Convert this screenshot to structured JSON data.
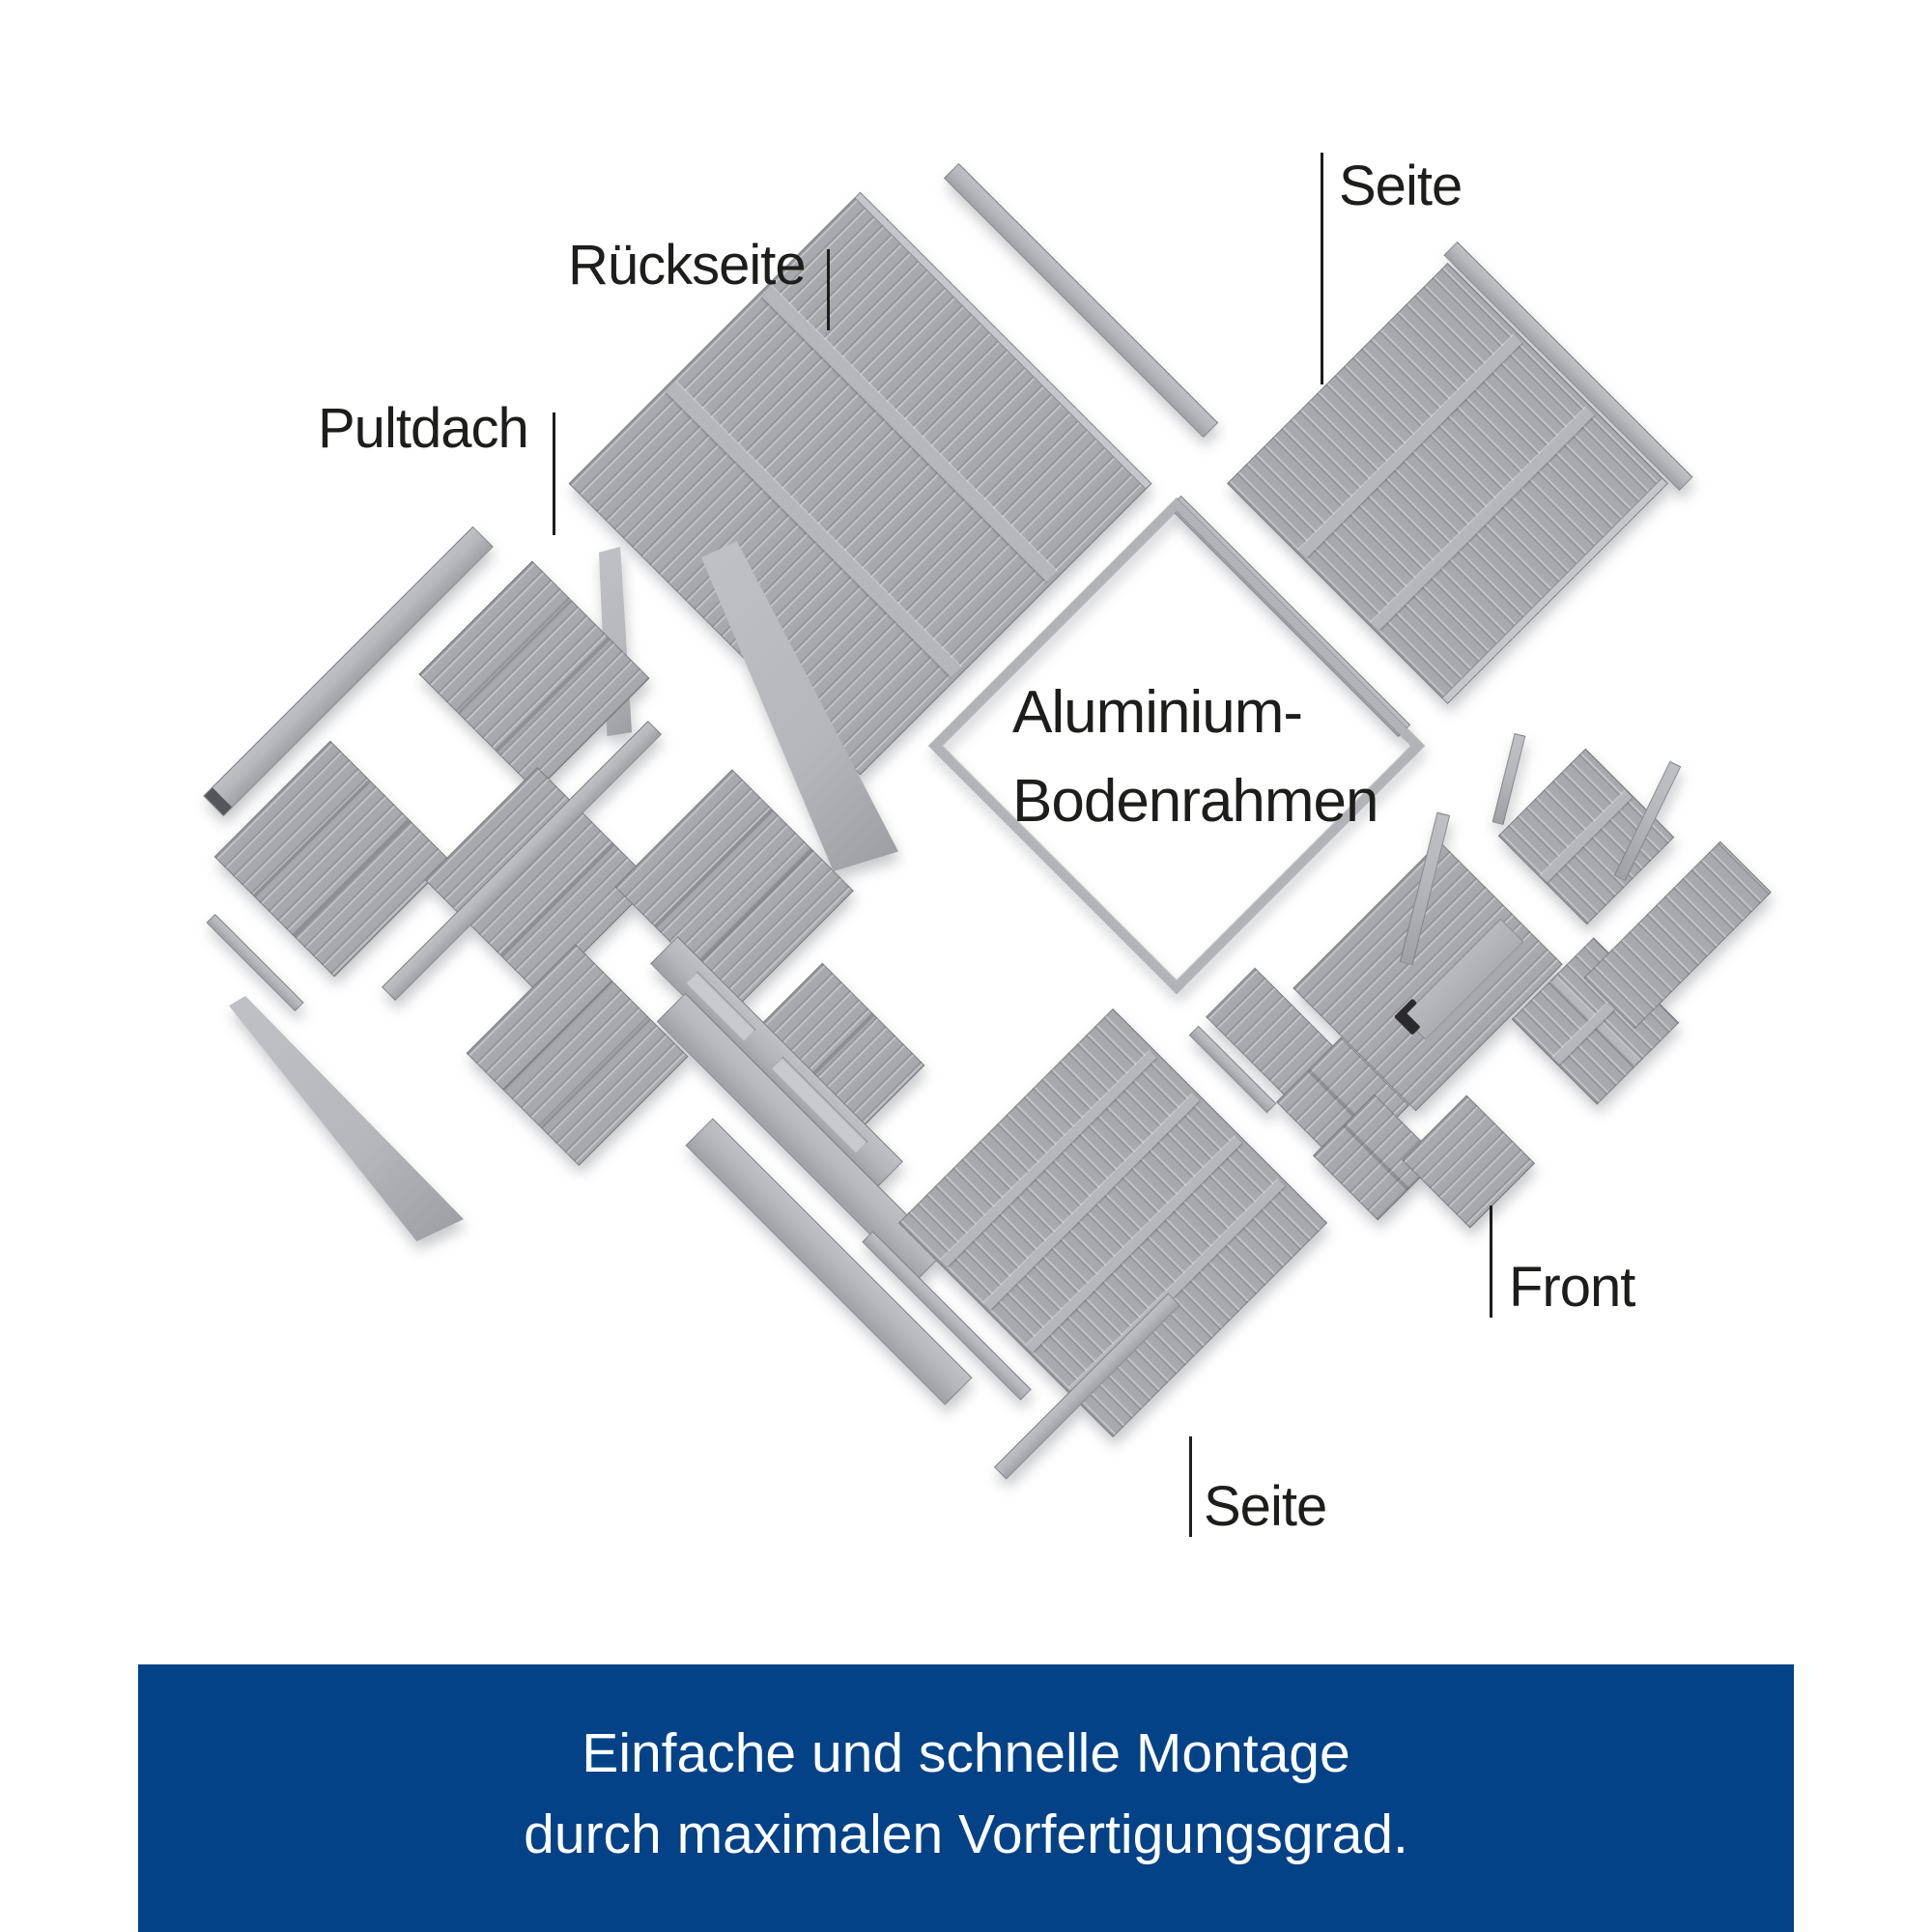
{
  "labels": {
    "seite_top": "Seite",
    "rueckseite": "Rückseite",
    "pultdach": "Pultdach",
    "bodenrahmen_line1": "Aluminium-",
    "bodenrahmen_line2": "Bodenrahmen",
    "front": "Front",
    "seite_bottom": "Seite"
  },
  "banner": {
    "line1": "Einfache und schnelle Montage",
    "line2": "durch maximalen Vorfertigungsgrad.",
    "background_color": "#034287",
    "text_color": "#ffffff"
  },
  "colors": {
    "background": "#ffffff",
    "label_text": "#1d1d1b",
    "leader_line": "#1d1d1b",
    "panel_gray": "#a8a9ac",
    "panel_stripe": "#94969a",
    "rail_gray": "#b6b7ba",
    "frame_gray": "#b2b3b6",
    "door_handle": "#2b2b2e"
  }
}
